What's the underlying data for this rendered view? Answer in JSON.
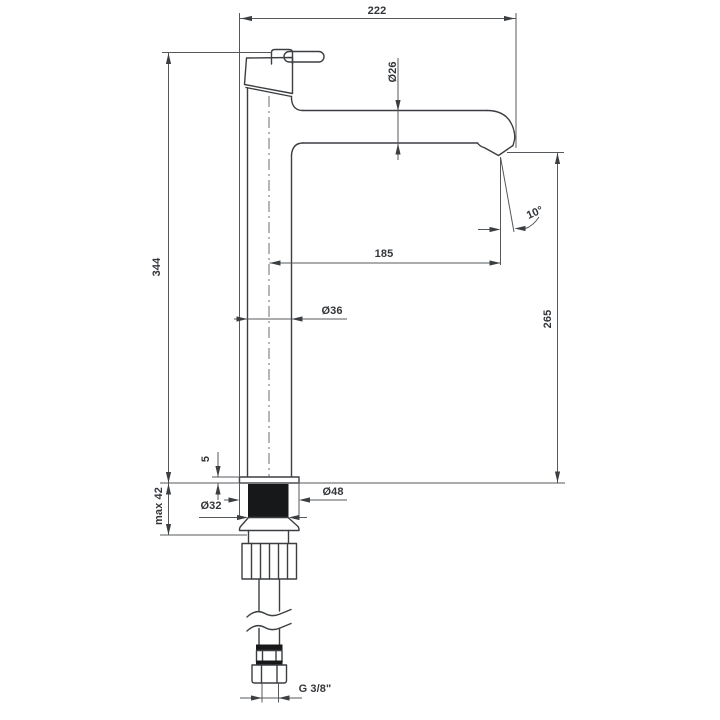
{
  "drawing": {
    "title": "tall single-lever basin mixer faucet – dimensioned side view",
    "type": "technical-dimension-drawing",
    "colors": {
      "background": "#ffffff",
      "object_line": "#3c3f42",
      "dimension_line": "#55585c",
      "label_text": "#33363a",
      "solid_fill": "#17181a"
    },
    "labels": {
      "width_total": "222",
      "spout_diameter": "Ø26",
      "height_total": "344",
      "spout_reach": "185",
      "body_diameter": "Ø36",
      "spout_height": "265",
      "plate_thickness": "5",
      "mounting_max_thickness": "max 42",
      "base_diameter": "Ø48",
      "mounting_hole_diameter": "Ø32",
      "spout_angle": "10°",
      "connection_thread": "G 3/8\""
    }
  }
}
